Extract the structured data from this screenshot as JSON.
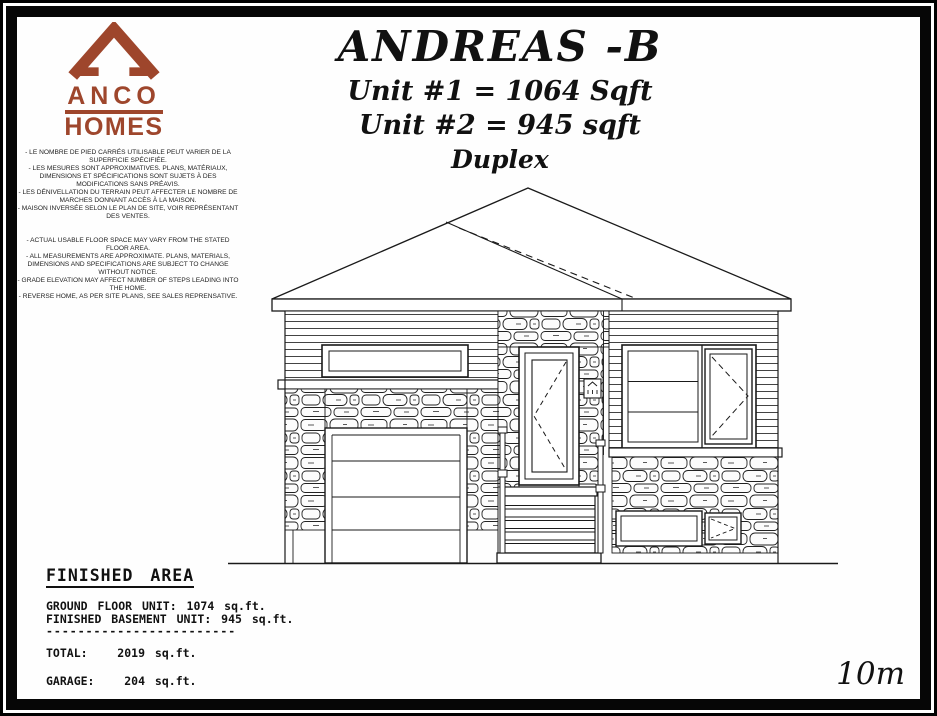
{
  "logo": {
    "line1": "ANCO",
    "line2": "HOMES",
    "color": "#9e462c"
  },
  "title": {
    "name": "ANDREAS -B",
    "unit1": "Unit #1 = 1064 Sqft",
    "unit2": "Unit #2 = 945 sqft",
    "type": "Duplex"
  },
  "disclaimer": {
    "french_items": [
      "- LE NOMBRE DE PIED CARRÉS UTILISABLE PEUT VARIER DE LA SUPERFICIE SPÉCIFIÉE.",
      "- LES MESURES SONT APPROXIMATIVES.  PLANS, MATÉRIAUX, DIMENSIONS ET SPÉCIFICATIONS SONT SUJETS À DES MODIFICATIONS SANS PRÉAVIS.",
      "- LES DÉNIVELLATION DU TERRAIN PEUT AFFECTER LE NOMBRE DE MARCHES DONNANT ACCÈS À LA MAISON.",
      "- MAISON INVERSÉE SELON LE PLAN DE SITE, VOIR REPRÉSENTANT DES VENTES."
    ],
    "english_items": [
      "- ACTUAL USABLE FLOOR SPACE MAY VARY FROM THE STATED FLOOR AREA.",
      "- ALL MEASUREMENTS ARE APPROXIMATE.  PLANS, MATERIALS, DIMENSIONS AND SPECIFICATIONS ARE SUBJECT TO CHANGE WITHOUT NOTICE.",
      "- GRADE ELEVATION MAY AFFECT NUMBER OF STEPS LEADING INTO THE HOME.",
      "- REVERSE HOME, AS PER SITE PLANS, SEE SALES REPRENSATIVE."
    ]
  },
  "finished_area": {
    "heading": "FINISHED AREA",
    "rows": [
      "GROUND FLOOR UNIT: 1074 sq.ft.",
      "FINISHED BASEMENT UNIT: 945 sq.ft."
    ],
    "divider": "------------------------",
    "total": "TOTAL:   2019 sq.ft.",
    "garage": "GARAGE:   204 sq.ft."
  },
  "scale": {
    "label": "10m"
  },
  "drawing": {
    "description": "duplex front elevation"
  }
}
